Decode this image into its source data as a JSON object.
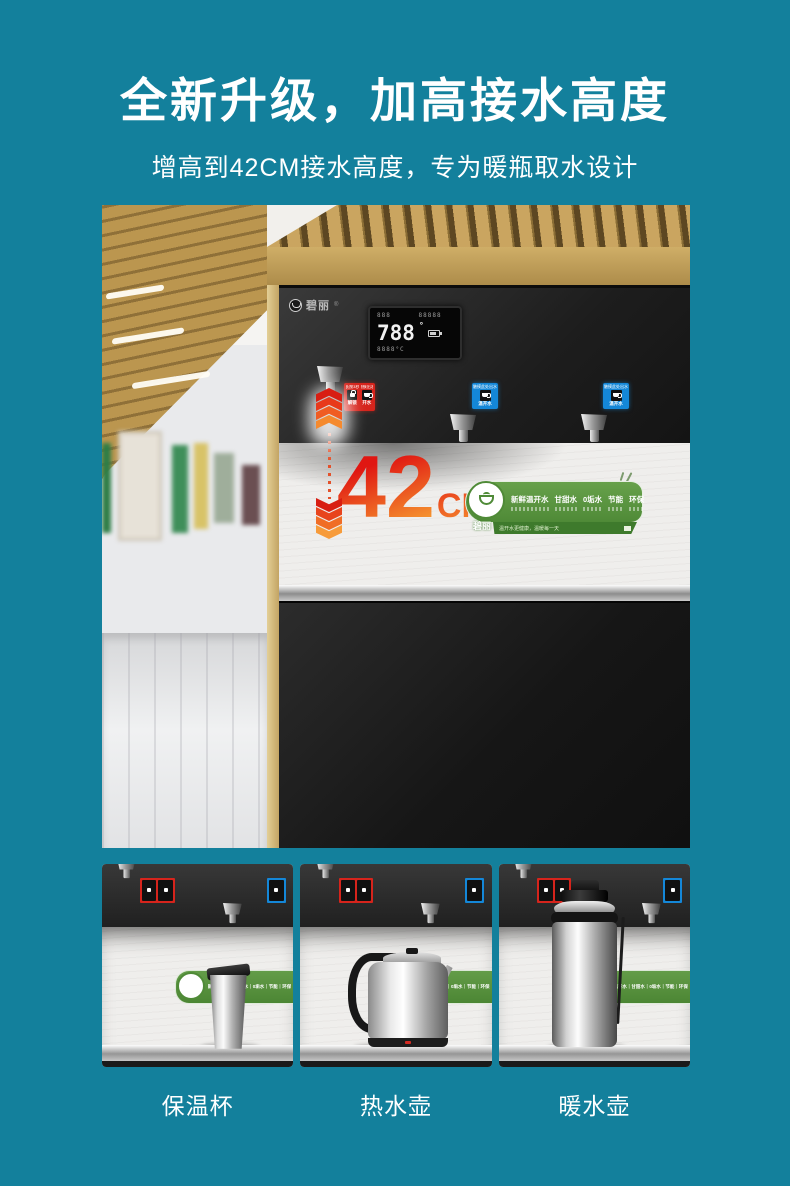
{
  "page": {
    "background": "#13809C"
  },
  "header": {
    "title": "全新升级，加高接水高度",
    "subtitle": "增高到42CM接水高度，专为暖瓶取水设计"
  },
  "hero": {
    "brand": "碧丽",
    "display": {
      "row1": "888      88888",
      "big": "788",
      "row3": "8888°C"
    },
    "panels": {
      "red": {
        "top_left": "长按3秒",
        "top_right": "触摸出水",
        "label_left": "解锁",
        "label_right": "开水"
      },
      "blue": {
        "top": "触摸此处出水",
        "label": "温开水"
      }
    },
    "measure": {
      "value": "42",
      "unit": "CM"
    },
    "banner": {
      "brand": "碧丽",
      "features": [
        "新鲜温开水",
        "甘甜水",
        "0垢水",
        "节能",
        "环保"
      ],
      "features_line": "新鲜温开水｜甘甜水｜0垢水｜节能｜环保",
      "tagline": "温开水更健康，温暖每一天"
    }
  },
  "thumbnails": [
    {
      "label": "保温杯"
    },
    {
      "label": "热水壶"
    },
    {
      "label": "暖水壶"
    }
  ]
}
